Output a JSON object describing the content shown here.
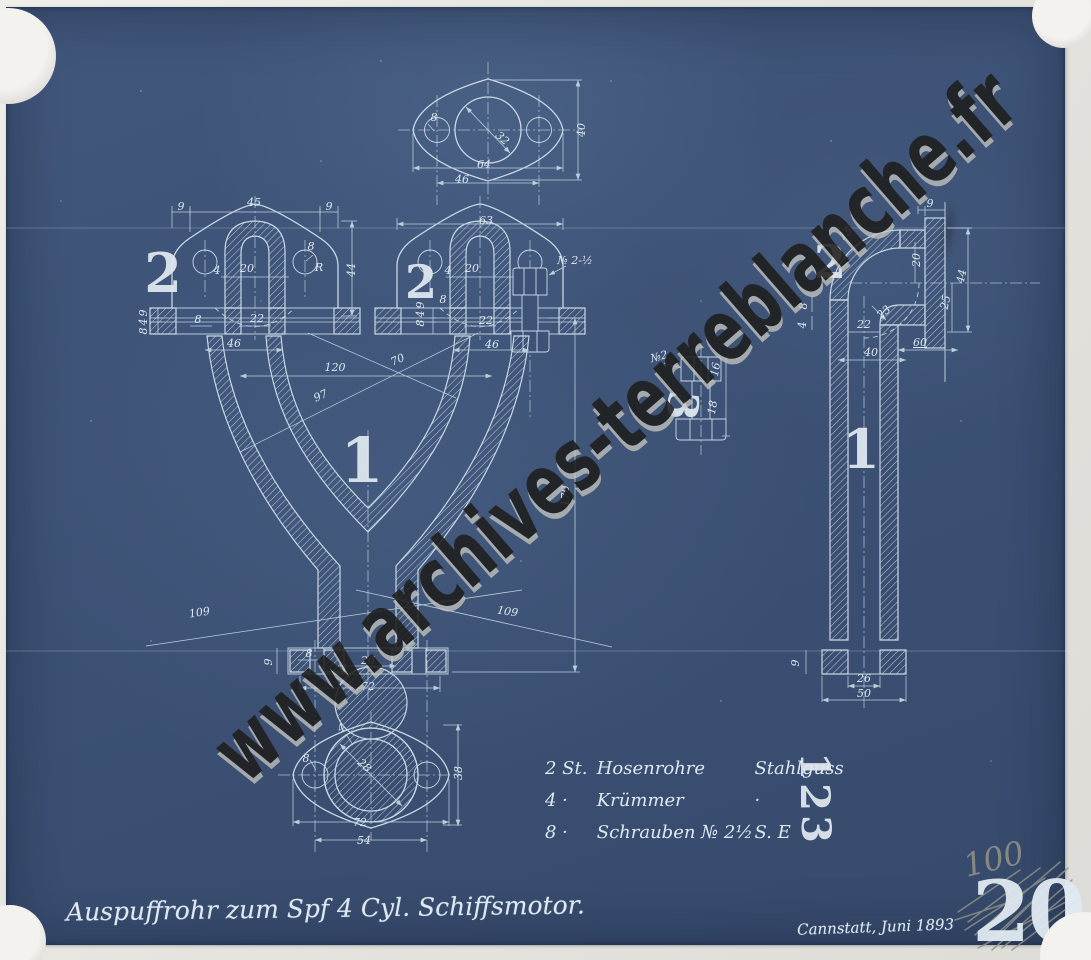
{
  "doc": {
    "title_script": "Auspuffrohr zum Spf 4 Cyl. Schiffsmotor.",
    "date_script": "Cannstatt, Juni 1893",
    "watermark": "www.archives-terreblanche.fr",
    "pencil_number": "100",
    "stamp_number": "20"
  },
  "colors": {
    "bg": "#3b5073",
    "bg2": "#41577c",
    "bg3": "#364a6c",
    "line": "#c9d8e5",
    "dim": "#bccfdd",
    "txt": "#dde8f1",
    "stencil": "#e1eaf1",
    "pencil": "#8f9086",
    "wmd": "#1f1f1d",
    "paper": "#e7e5e0"
  },
  "parts_list": {
    "rows": [
      {
        "qty": "2 St.",
        "name": "Hosenrohre",
        "material": "Stahlguss"
      },
      {
        "qty": "4 ·",
        "name": "Krümmer",
        "material": "·"
      },
      {
        "qty": "8 ·",
        "name": "Schrauben № 2½",
        "material": "S. E"
      }
    ]
  },
  "labels": {
    "dims": [
      {
        "t": "64",
        "x": 484,
        "y": 168
      },
      {
        "t": "46",
        "x": 462,
        "y": 183
      },
      {
        "t": "40",
        "x": 585,
        "y": 130,
        "r": -90
      },
      {
        "t": "32",
        "x": 500,
        "y": 141,
        "r": 42
      },
      {
        "t": "8",
        "x": 434,
        "y": 121,
        "s": 9
      },
      {
        "t": "9",
        "x": 181,
        "y": 210
      },
      {
        "t": "45",
        "x": 254,
        "y": 206
      },
      {
        "t": "9",
        "x": 329,
        "y": 210
      },
      {
        "t": "44",
        "x": 355,
        "y": 270,
        "r": -90
      },
      {
        "t": "4",
        "x": 217,
        "y": 274,
        "s": 9
      },
      {
        "t": "20",
        "x": 247,
        "y": 272
      },
      {
        "t": "8",
        "x": 311,
        "y": 250,
        "s": 9
      },
      {
        "t": "R",
        "x": 319,
        "y": 271,
        "s": 9
      },
      {
        "t": "9",
        "x": 147,
        "y": 313,
        "s": 8,
        "r": -90
      },
      {
        "t": "4",
        "x": 147,
        "y": 322,
        "s": 8,
        "r": -90
      },
      {
        "t": "8",
        "x": 147,
        "y": 331,
        "s": 8,
        "r": -90
      },
      {
        "t": "8",
        "x": 198,
        "y": 323,
        "s": 9
      },
      {
        "t": "22",
        "x": 257,
        "y": 322
      },
      {
        "t": "46",
        "x": 234,
        "y": 347
      },
      {
        "t": "63",
        "x": 486,
        "y": 224
      },
      {
        "t": "4",
        "x": 448,
        "y": 274,
        "s": 9
      },
      {
        "t": "20",
        "x": 472,
        "y": 272
      },
      {
        "t": "9",
        "x": 424,
        "y": 305,
        "s": 8,
        "r": -90
      },
      {
        "t": "4",
        "x": 424,
        "y": 314,
        "s": 8,
        "r": -90
      },
      {
        "t": "8",
        "x": 424,
        "y": 323,
        "s": 8,
        "r": -90
      },
      {
        "t": "8",
        "x": 443,
        "y": 303,
        "s": 9
      },
      {
        "t": "22",
        "x": 486,
        "y": 324
      },
      {
        "t": "46",
        "x": 492,
        "y": 348
      },
      {
        "t": "№ 2-½",
        "x": 575,
        "y": 264,
        "s": 10
      },
      {
        "t": "120",
        "x": 335,
        "y": 371
      },
      {
        "t": "97",
        "x": 322,
        "y": 399,
        "r": -24
      },
      {
        "t": "70",
        "x": 399,
        "y": 363,
        "r": -24
      },
      {
        "t": "109",
        "x": 200,
        "y": 616,
        "r": -9
      },
      {
        "t": "109",
        "x": 507,
        "y": 615,
        "r": 9
      },
      {
        "t": "170",
        "x": 569,
        "y": 496,
        "r": -90
      },
      {
        "t": "9",
        "x": 272,
        "y": 662,
        "r": -90
      },
      {
        "t": "8",
        "x": 309,
        "y": 657,
        "s": 9
      },
      {
        "t": "26",
        "x": 368,
        "y": 664
      },
      {
        "t": "72",
        "x": 368,
        "y": 690
      },
      {
        "t": "4",
        "x": 343,
        "y": 731,
        "s": 9,
        "r": -30
      },
      {
        "t": "28",
        "x": 362,
        "y": 768,
        "r": 42
      },
      {
        "t": "8",
        "x": 306,
        "y": 762,
        "s": 9
      },
      {
        "t": "38",
        "x": 462,
        "y": 773,
        "r": -90
      },
      {
        "t": "72",
        "x": 360,
        "y": 826
      },
      {
        "t": "54",
        "x": 364,
        "y": 844
      },
      {
        "t": "9",
        "x": 930,
        "y": 207
      },
      {
        "t": "15",
        "x": 848,
        "y": 236,
        "r": -40,
        "s": 9
      },
      {
        "t": "23",
        "x": 886,
        "y": 315,
        "r": -40,
        "s": 9
      },
      {
        "t": "20",
        "x": 920,
        "y": 260,
        "r": -90
      },
      {
        "t": "25",
        "x": 949,
        "y": 303,
        "r": -78
      },
      {
        "t": "44",
        "x": 965,
        "y": 277,
        "r": -78
      },
      {
        "t": "60",
        "x": 920,
        "y": 346,
        "u": 1
      },
      {
        "t": "22",
        "x": 864,
        "y": 328,
        "s": 9
      },
      {
        "t": "40",
        "x": 871,
        "y": 356
      },
      {
        "t": "8",
        "x": 807,
        "y": 306,
        "s": 8,
        "r": -90
      },
      {
        "t": "4",
        "x": 806,
        "y": 325,
        "s": 8,
        "r": -90
      },
      {
        "t": "9",
        "x": 799,
        "y": 663,
        "r": -90
      },
      {
        "t": "26",
        "x": 864,
        "y": 682
      },
      {
        "t": "50",
        "x": 864,
        "y": 697
      },
      {
        "t": "№2",
        "x": 660,
        "y": 360,
        "s": 9,
        "r": -15
      },
      {
        "t": "16",
        "x": 719,
        "y": 370,
        "r": -80,
        "s": 9
      },
      {
        "t": "18",
        "x": 716,
        "y": 408,
        "r": -80,
        "s": 9
      }
    ],
    "stencils": [
      {
        "t": "2",
        "x": 163,
        "y": 292,
        "s": 54
      },
      {
        "t": "2",
        "x": 421,
        "y": 298,
        "s": 46
      },
      {
        "t": "2",
        "x": 830,
        "y": 278,
        "s": 46
      },
      {
        "t": "1",
        "x": 362,
        "y": 482,
        "s": 62
      },
      {
        "t": "1",
        "x": 861,
        "y": 468,
        "s": 54
      },
      {
        "t": "3",
        "x": 668,
        "y": 404,
        "s": 42,
        "r": 96
      },
      {
        "t": "1",
        "x": 801,
        "y": 766,
        "s": 40,
        "r": 90
      },
      {
        "t": "2",
        "x": 801,
        "y": 797,
        "s": 40,
        "r": 90
      },
      {
        "t": "3",
        "x": 802,
        "y": 829,
        "s": 40,
        "r": 90
      }
    ]
  }
}
